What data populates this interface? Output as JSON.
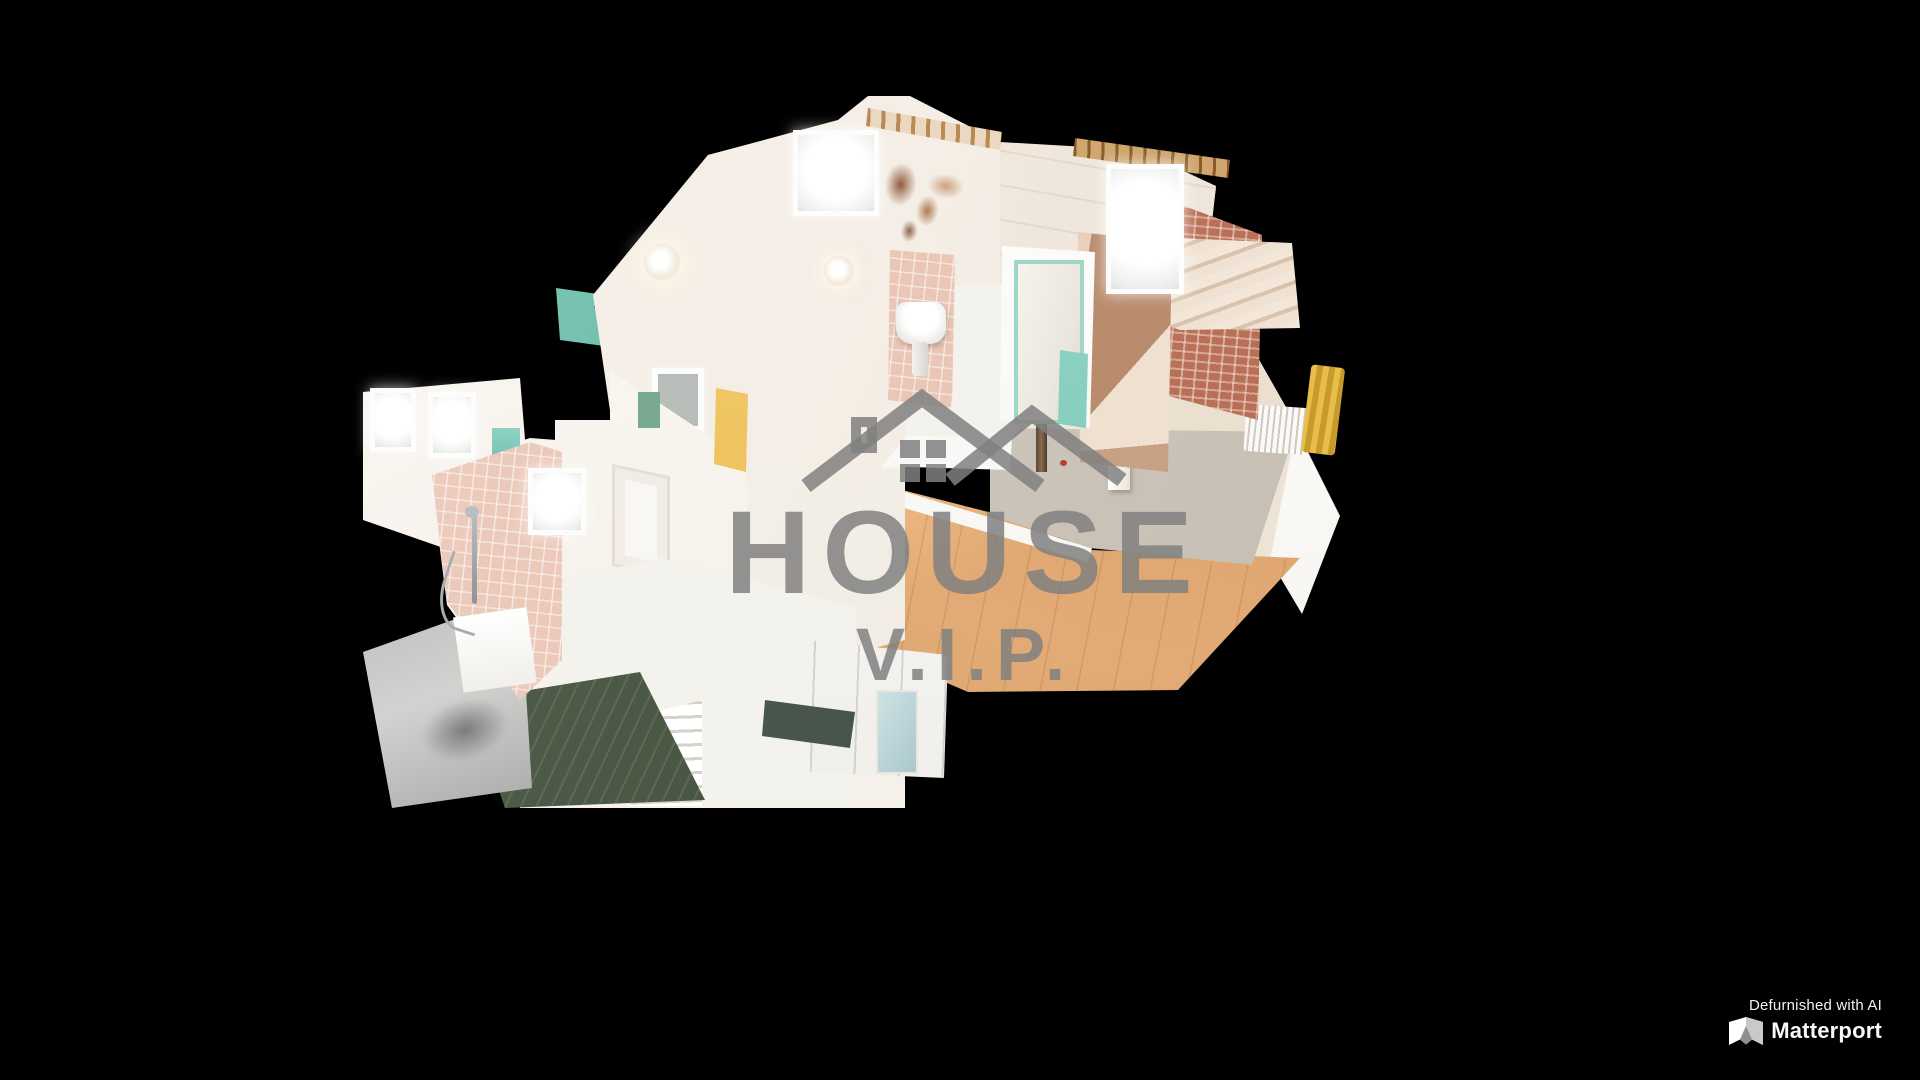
{
  "watermark": {
    "title": "HOUSE",
    "subtitle": "V.I.P.",
    "logo_icon": "house-roof-icon",
    "color": "#8c8c8c"
  },
  "branding": {
    "defurnished_label": "Defurnished with AI",
    "matterport_label": "Matterport",
    "matterport_icon": "matterport-m-icon",
    "text_color": "#ffffff"
  },
  "scene": {
    "view_label": "3D dollhouse cutaway view of an empty apartment",
    "background": "#000000",
    "colors": {
      "walls": "#f6f0e9",
      "tile_floor": "#f4f2ed",
      "wood_floor": "#d99a64",
      "concrete_floor": "#ccc4b9",
      "pink_tiles": "#e8c2b2",
      "teal_accent": "#8fd4c6",
      "dark_green": "#2f7a5a",
      "brick": "#ba7158"
    }
  }
}
